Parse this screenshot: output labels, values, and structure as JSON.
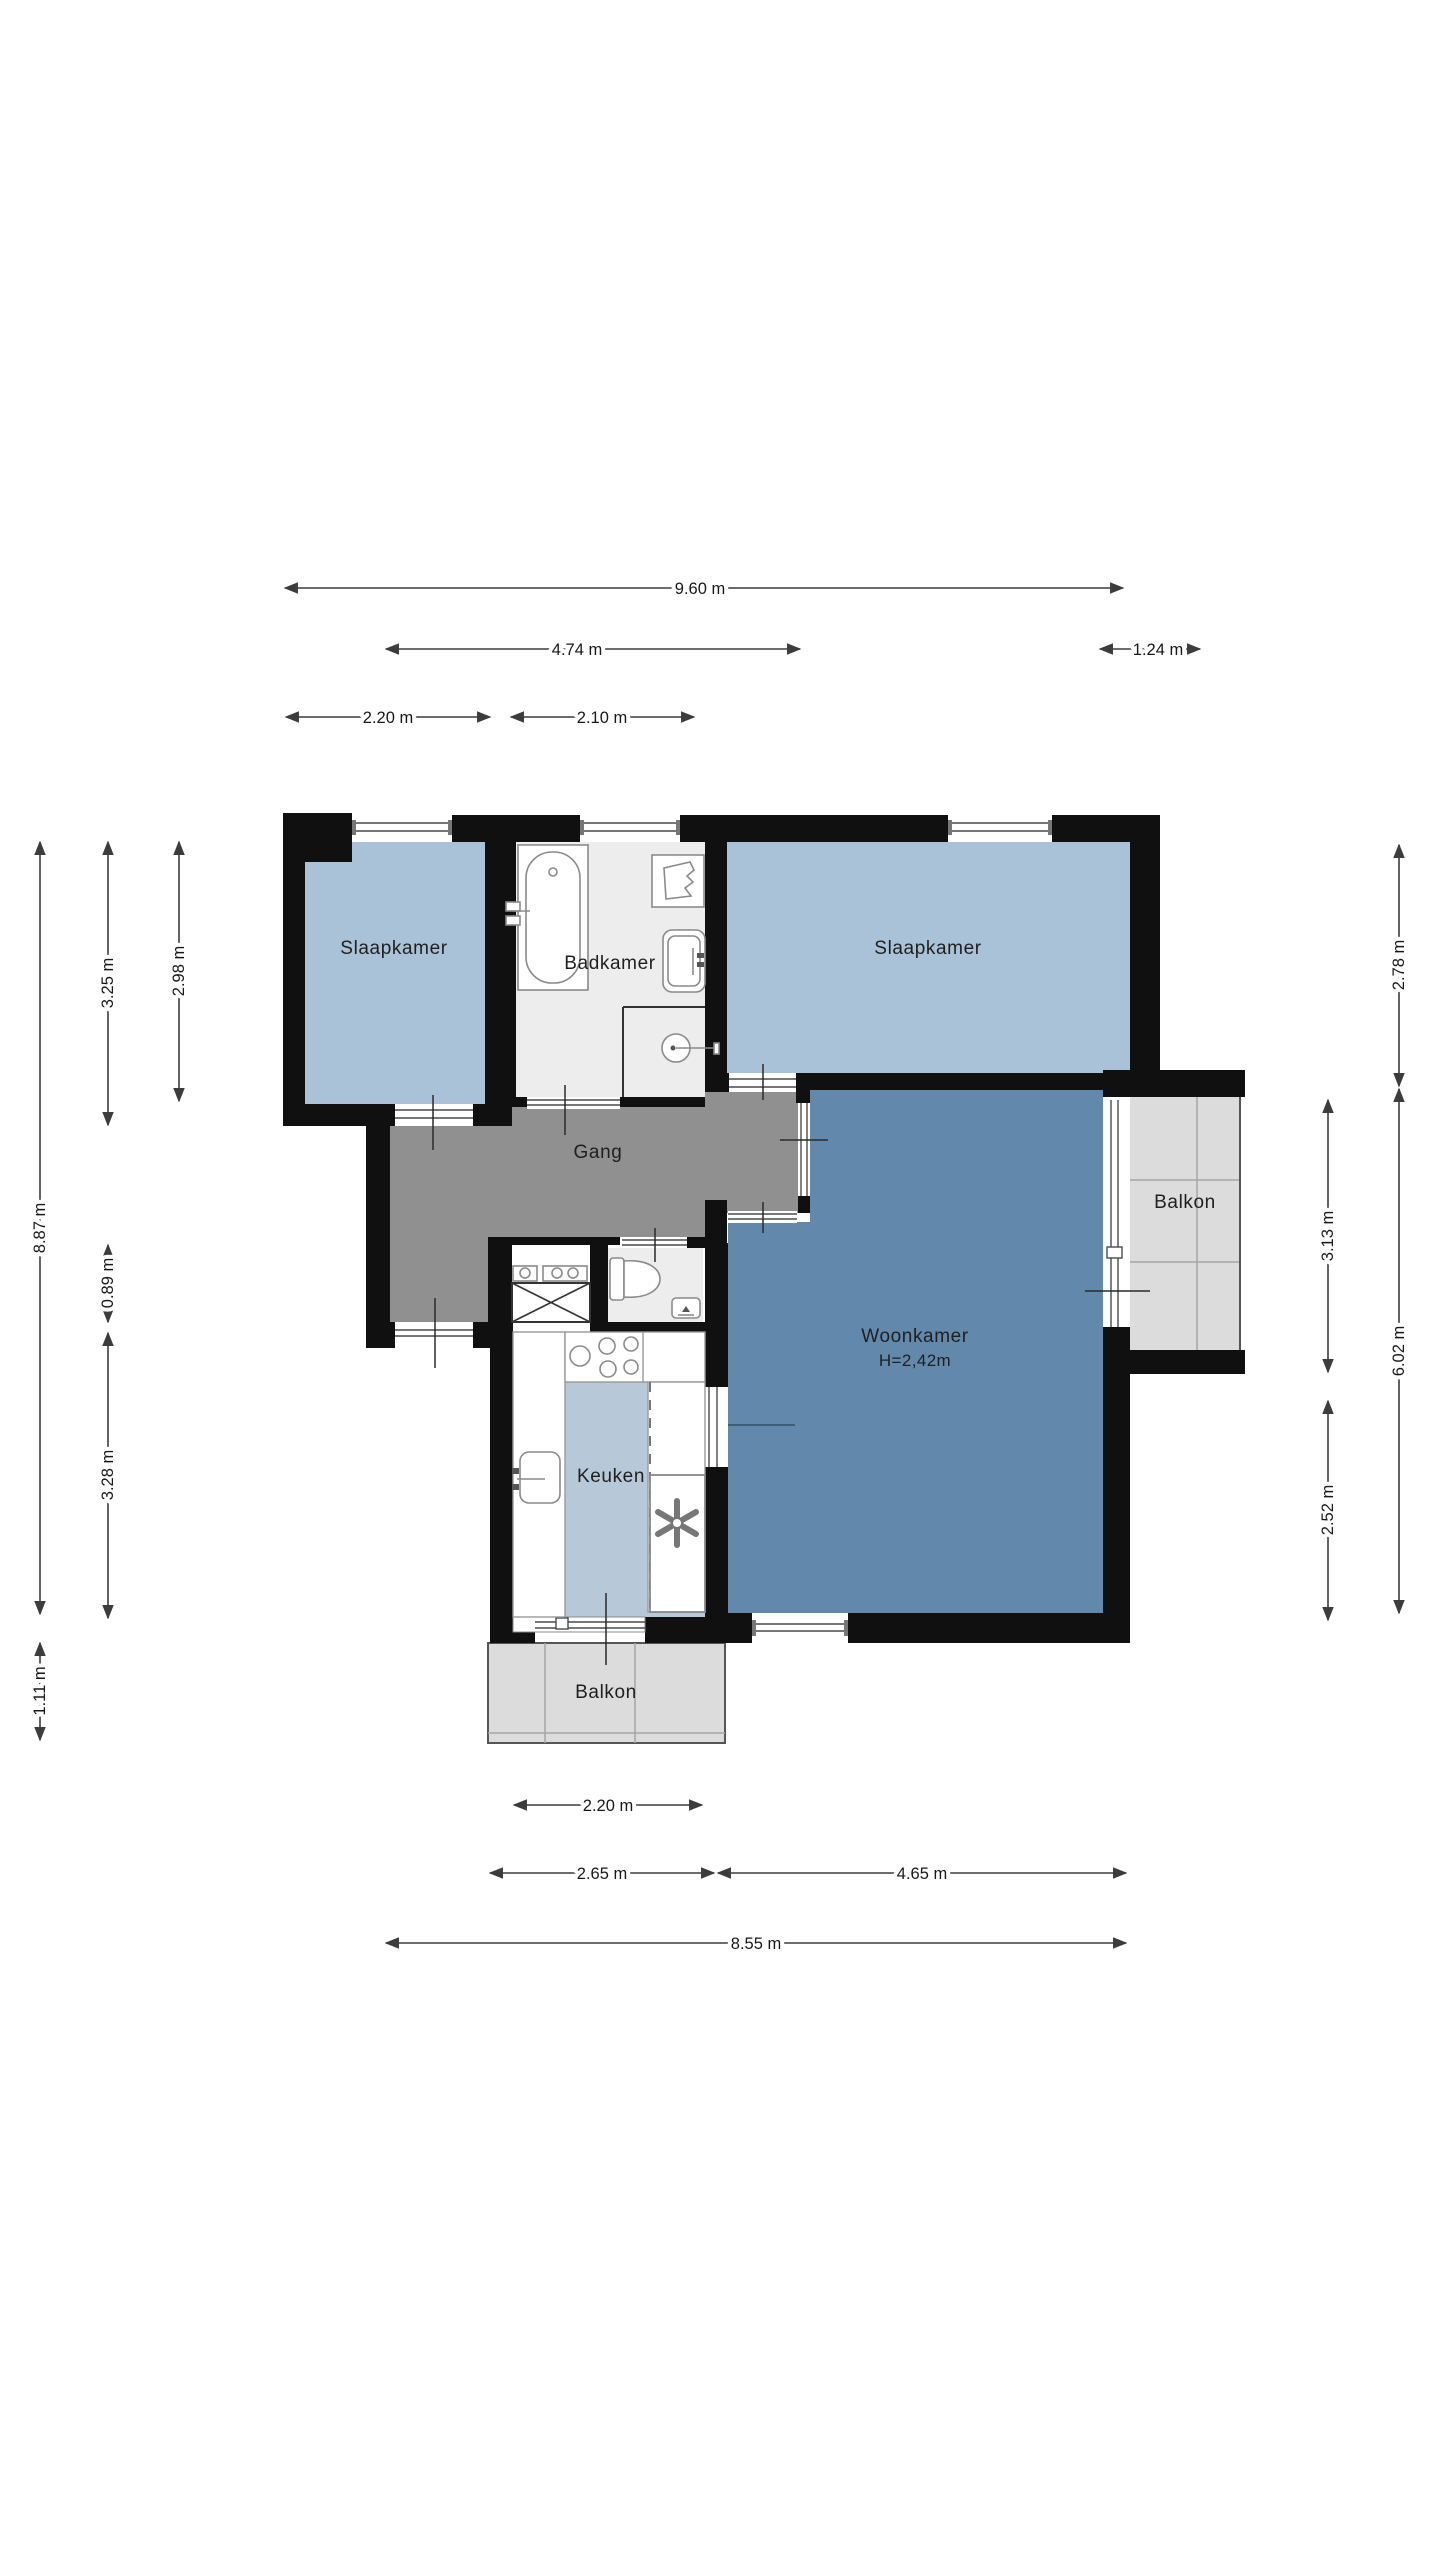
{
  "title": "Apartment floor plan",
  "colors": {
    "wall": "#101010",
    "bedroom_fill": "#a9c2d7",
    "living_fill": "#6289ac",
    "kitchen_fill": "#b7c9d9",
    "hallway_fill": "#909090",
    "bathroom_fill": "#ededed",
    "balcony_fill": "#dcdcdc",
    "dimension_line": "#3c3c3c",
    "background": "#ffffff"
  },
  "rooms": {
    "bedroom_left": "Slaapkamer",
    "bathroom": "Badkamer",
    "bedroom_right": "Slaapkamer",
    "hallway": "Gang",
    "living": "Woonkamer",
    "living_ceiling_height": "H=2,42m",
    "kitchen": "Keuken",
    "balcony_right": "Balkon",
    "balcony_bottom": "Balkon"
  },
  "icons": {
    "bathtub": "bathtub-icon",
    "shower": "shower-icon",
    "washbasin": "washbasin-icon",
    "boiler": "boiler-icon",
    "toilet": "toilet-icon",
    "corner-sink": "corner-sink-icon",
    "stove": "stove-icon",
    "kitchen-sink": "kitchen-sink-icon",
    "ventilation-fan": "ventilation-fan-icon",
    "utility-meters": "utility-meters-icon",
    "meter-cabinet": "meter-cabinet-icon"
  },
  "dimensions": {
    "top": {
      "total": "9.60 m",
      "left_section": "4.74 m",
      "balcony": "1.24 m",
      "bedroom": "2.20 m",
      "bathroom": "2.10 m"
    },
    "left": {
      "total": "8.87 m",
      "bedroom": "3.25 m",
      "bathroom": "2.98 m",
      "hall": "0.89 m",
      "kitchen": "3.28 m",
      "balcony": "1.11 m"
    },
    "right": {
      "bedroom": "2.78 m",
      "balcony": "3.13 m",
      "living_total": "6.02 m",
      "living_lower": "2.52 m"
    },
    "bottom": {
      "kitchen": "2.20 m",
      "kitchen_section": "2.65 m",
      "living_section": "4.65 m",
      "total": "8.55 m"
    }
  }
}
